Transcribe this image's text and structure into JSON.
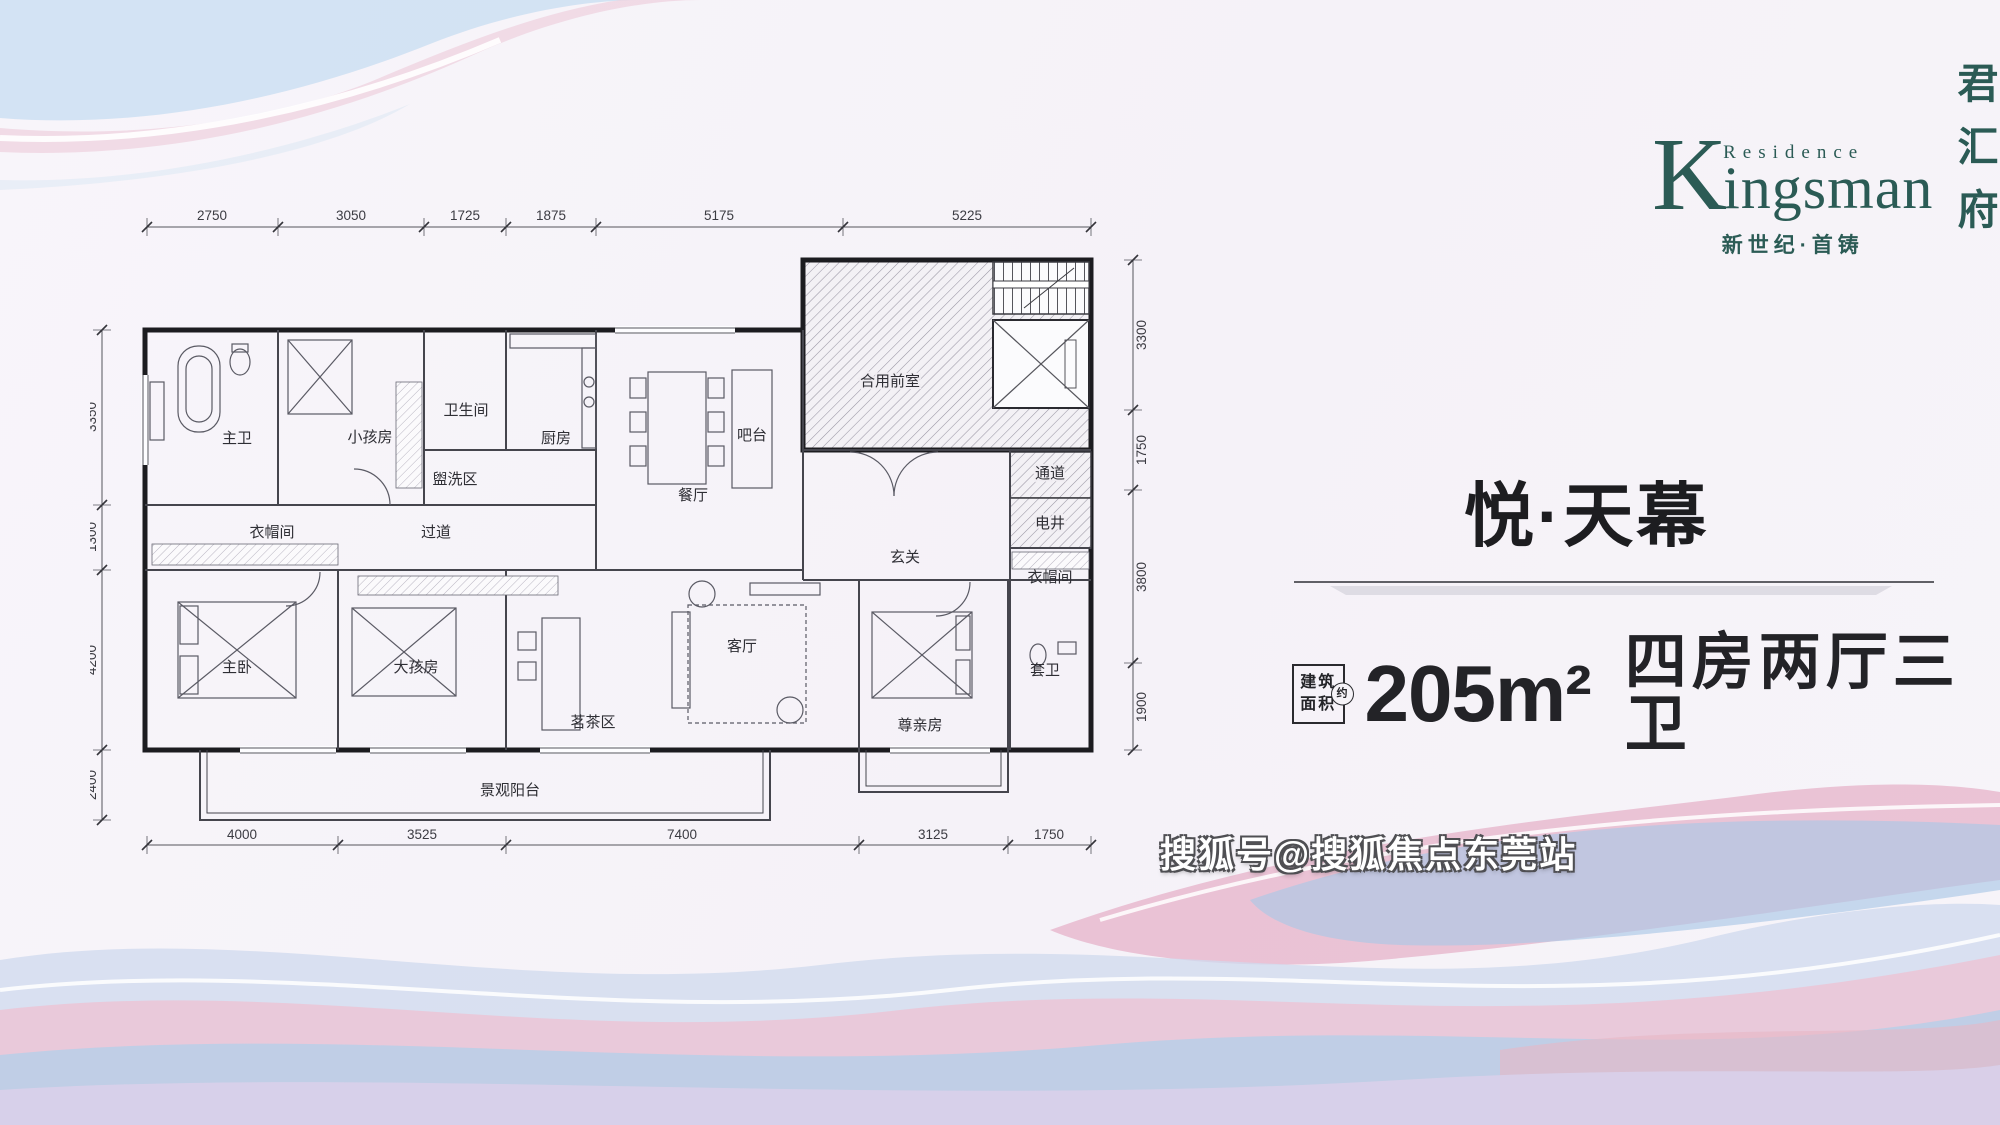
{
  "brand": {
    "residence": "Residence",
    "name_initial": "K",
    "name_rest": "ingsman",
    "vertical_name": [
      "君",
      "汇",
      "府"
    ],
    "tagline": "新世纪·首铸",
    "color": "#2b5b55"
  },
  "unit": {
    "title": "悦·天幕",
    "area_box_line1": "建筑",
    "area_box_line2": "面积",
    "area_approx": "约",
    "area_value": "205m²",
    "rooms_spec": "四房两厅三卫"
  },
  "watermark": {
    "text": "搜狐号@搜狐焦点东莞站"
  },
  "floorplan": {
    "dims": {
      "top": [
        "2750",
        "3050",
        "1725",
        "1875",
        "5175",
        "5225"
      ],
      "bottom": [
        "4000",
        "3525",
        "7400",
        "3125",
        "1750"
      ],
      "left": [
        "3350",
        "1300",
        "4200",
        "2400"
      ],
      "right": [
        "3300",
        "1750",
        "3800",
        "1900"
      ]
    },
    "rooms": [
      {
        "id": "master-bath",
        "label": "主卫"
      },
      {
        "id": "kids-room",
        "label": "小孩房"
      },
      {
        "id": "bathroom",
        "label": "卫生间"
      },
      {
        "id": "wash-area",
        "label": "盥洗区"
      },
      {
        "id": "kitchen",
        "label": "厨房"
      },
      {
        "id": "bar",
        "label": "吧台"
      },
      {
        "id": "dining-room",
        "label": "餐厅"
      },
      {
        "id": "shared-front-room",
        "label": "合用前室"
      },
      {
        "id": "passage",
        "label": "通道"
      },
      {
        "id": "utility-shaft",
        "label": "电井"
      },
      {
        "id": "cloakroom-left",
        "label": "衣帽间"
      },
      {
        "id": "corridor",
        "label": "过道"
      },
      {
        "id": "foyer",
        "label": "玄关"
      },
      {
        "id": "cloakroom-right",
        "label": "衣帽间"
      },
      {
        "id": "master-bedroom",
        "label": "主卧"
      },
      {
        "id": "elder-kids-room",
        "label": "大孩房"
      },
      {
        "id": "tea-area",
        "label": "茗茶区"
      },
      {
        "id": "living-room",
        "label": "客厅"
      },
      {
        "id": "elder-room",
        "label": "尊亲房"
      },
      {
        "id": "ensuite-bath",
        "label": "套卫"
      },
      {
        "id": "balcony",
        "label": "景观阳台"
      }
    ]
  }
}
